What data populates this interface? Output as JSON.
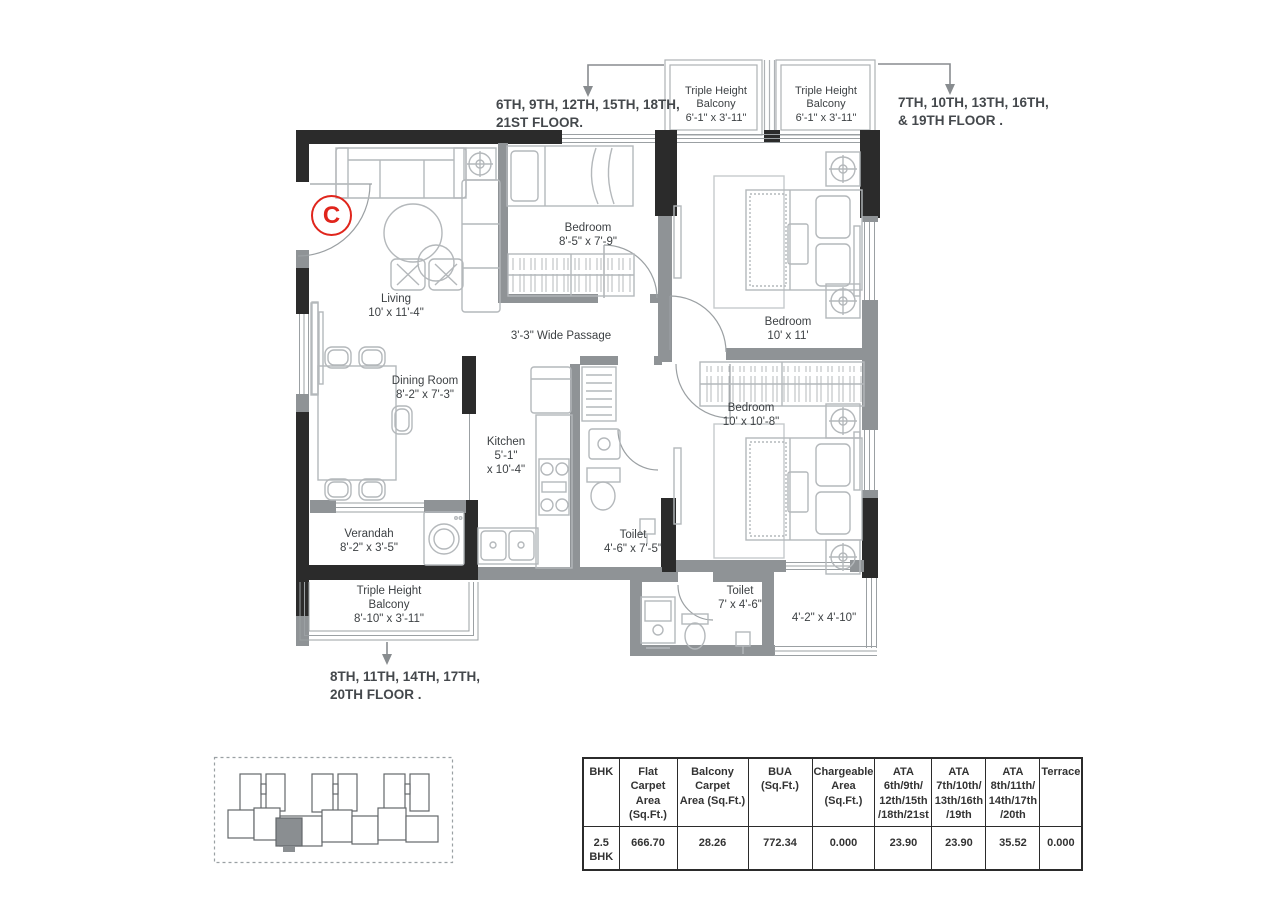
{
  "unit": {
    "label": "C"
  },
  "annotations": {
    "top_left": {
      "line1": "6TH, 9TH, 12TH, 15TH, 18TH,",
      "line2": "21ST FLOOR."
    },
    "top_right": {
      "line1": "7TH, 10TH, 13TH, 16TH,",
      "line2": "& 19TH FLOOR ."
    },
    "bottom": {
      "line1": "8TH, 11TH, 14TH, 17TH,",
      "line2": "20TH FLOOR ."
    }
  },
  "rooms": {
    "balcony_top_left": {
      "l1": "Triple Height",
      "l2": "Balcony",
      "dims": "6'-1\" x 3'-11\""
    },
    "balcony_top_right": {
      "l1": "Triple Height",
      "l2": "Balcony",
      "dims": "6'-1\" x 3'-11\""
    },
    "bedroom_top": {
      "name": "Bedroom",
      "dims": "8'-5\" x 7'-9\""
    },
    "bedroom_right": {
      "name": "Bedroom",
      "dims": "10' x 11'"
    },
    "bedroom_bottom": {
      "name": "Bedroom",
      "dims": "10' x 10'-8\""
    },
    "living": {
      "name": "Living",
      "dims": "10' x 11'-4\""
    },
    "dining": {
      "name": "Dining Room",
      "dims": "8'-2\" x 7'-3\""
    },
    "kitchen": {
      "name": "Kitchen",
      "dims1": "5'-1\"",
      "dims2": "x 10'-4\""
    },
    "passage": {
      "name": "3'-3\"  Wide Passage"
    },
    "toilet_mid": {
      "name": "Toilet",
      "dims": "4'-6\" x 7'-5\""
    },
    "verandah": {
      "name": "Verandah",
      "dims": "8'-2\" x 3'-5\""
    },
    "balcony_bottom": {
      "l1": "Triple Height",
      "l2": "Balcony",
      "dims": "8'-10\" x 3'-11\""
    },
    "toilet_bottom": {
      "name": "Toilet",
      "dims": "7' x 4'-6\""
    },
    "deck": {
      "dims": "4'-2\" x 4'-10\""
    }
  },
  "table": {
    "headers": [
      "BHK",
      "Flat Carpet\nArea (Sq.Ft.)",
      "Balcony Carpet\nArea (Sq.Ft.)",
      "BUA\n(Sq.Ft.)",
      "Chargeable\nArea (Sq.Ft.)",
      "ATA\n6th/9th/\n12th/15th\n/18th/21st",
      "ATA\n7th/10th/\n13th/16th\n/19th",
      "ATA\n8th/11th/\n14th/17th\n/20th",
      "Terrace"
    ],
    "row": [
      "2.5\nBHK",
      "666.70",
      "28.26",
      "772.34",
      "0.000",
      "23.90",
      "23.90",
      "35.52",
      "0.000"
    ]
  },
  "colors": {
    "wall_dark": "#2b2b2b",
    "wall_gray": "#8f9396",
    "accent_red": "#e0251c",
    "text": "#3d4144"
  }
}
